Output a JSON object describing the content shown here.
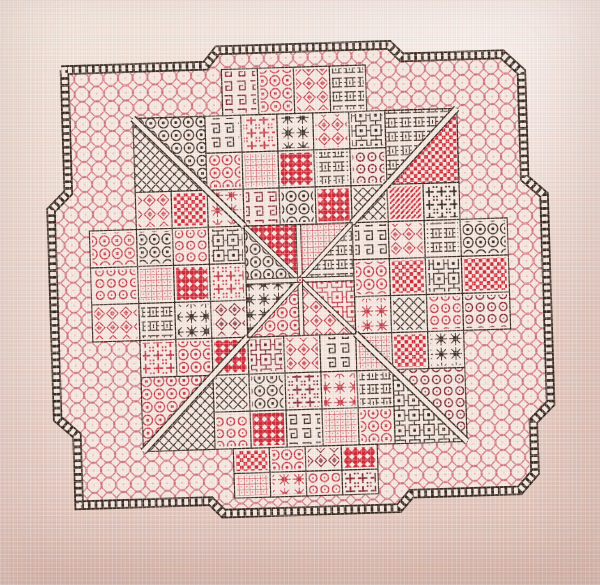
{
  "scene": {
    "type": "photograph",
    "subject": "Blackwork embroidery sampler stitched in black and red thread on pale pink aida fabric; square patchwork of diaper-pattern blocks inside a stepped ladder border with a honeycomb band and a central eight-wedge star",
    "fabric_colors": {
      "highlight": "#f6ece2",
      "base": "#eedcd2",
      "shadow": "#dfc2b7"
    },
    "thread_colors": {
      "black": "#362a20",
      "red": "#c23744",
      "brightred": "#cf2a39",
      "darkred": "#7d2530",
      "pink": "#cb5f6b",
      "white": "#f6e9e2"
    }
  },
  "design": {
    "rotation_deg": -1.8,
    "scale": [
      1.045,
      1.075
    ],
    "canvas": {
      "left": 48,
      "top": 52,
      "width": 520,
      "height": 490
    },
    "outline_points": [
      [
        30,
        26
      ],
      [
        168,
        26
      ],
      [
        180,
        12
      ],
      [
        344,
        12
      ],
      [
        356,
        24
      ],
      [
        452,
        24
      ],
      [
        470,
        41
      ],
      [
        470,
        140
      ],
      [
        488,
        156
      ],
      [
        488,
        350
      ],
      [
        471,
        366
      ],
      [
        471,
        414
      ],
      [
        456,
        430
      ],
      [
        352,
        430
      ],
      [
        340,
        443
      ],
      [
        172,
        443
      ],
      [
        160,
        431
      ],
      [
        34,
        431
      ],
      [
        34,
        366
      ],
      [
        16,
        350
      ],
      [
        16,
        156
      ],
      [
        33,
        140
      ],
      [
        33,
        26
      ]
    ],
    "ladder": {
      "band_width": 9,
      "inner_width": 5.6,
      "dash_on": 3.8,
      "dash_off": 2.6
    },
    "band_pattern": "honey.pink",
    "field": {
      "x": 97,
      "y": 73,
      "cell": 34.44,
      "cols": 9,
      "rows": 9
    },
    "grid": [
      [
        null,
        null,
        "knot.black",
        "cross.red",
        "star.black",
        "flower.red",
        "scroll.black",
        null,
        null
      ],
      [
        null,
        null,
        "oct.red",
        "grid.red",
        "dense.brightred",
        "basket.black",
        "rings.darkred",
        null,
        null
      ],
      [
        "flower.red",
        "checker.brightred",
        "star.red",
        "knot.darkred",
        "oct.black",
        "dense.brightred",
        "lattice.black",
        "hatch.brightred",
        "cross.black"
      ],
      [
        "oct.black",
        "rings.red",
        "scroll.black",
        null,
        null,
        null,
        "knot.black",
        "flower.red",
        "basket.black"
      ],
      [
        "grid.red",
        "dense.brightred",
        "cross.red",
        null,
        null,
        null,
        "oct.red",
        "checker.brightred",
        "scroll.black"
      ],
      [
        "basket.black",
        "star.black",
        "flower.darkred",
        null,
        null,
        null,
        "star.red",
        "lattice.black",
        "rings.red"
      ],
      [
        "cross.red",
        "oct.red",
        "dense.brightred",
        "scroll.darkred",
        "flower.red",
        "knot.black",
        "grid.red",
        "checker.brightred",
        "star.black"
      ],
      [
        null,
        null,
        "lattice.black",
        "oct.black",
        "cross.darkred",
        "star.red",
        "basket.black",
        null,
        null
      ],
      [
        null,
        null,
        "rings.red",
        "dense.brightred",
        "knot.black",
        "grid.red",
        "oct.red",
        null,
        null
      ]
    ],
    "corner_blocks": {
      "tl": [
        "oct.black",
        "lattice.black"
      ],
      "tr": [
        "basket.black",
        "checker.brightred"
      ],
      "bl": [
        "oct.red",
        "lattice.black"
      ],
      "br": [
        "rings.darkred",
        "scroll.black"
      ]
    },
    "center": {
      "wedges": [
        "dense.brightred",
        "grid.red",
        "basket.black",
        "scroll.red",
        "flower.red",
        "oct.red",
        "star.black",
        "oct.black"
      ]
    },
    "extensions": {
      "top": {
        "x": 183.1,
        "y": 30,
        "w": 34.44,
        "h": 43,
        "patterns": [
          "knot.darkred",
          "oct.red",
          "flower.red",
          "basket.black"
        ]
      },
      "bottom": {
        "x": 183.1,
        "y": 383,
        "w": 34.44,
        "h": 23,
        "rows": [
          [
            "checker.brightred",
            "oct.red",
            "flower.darkred",
            "dense.brightred"
          ],
          [
            "grid.red",
            "star.red",
            "rings.red",
            "cross.darkred"
          ]
        ]
      },
      "left": {
        "x": 52,
        "y": 176.32,
        "w": 45,
        "h": 34.44,
        "patterns": [
          "oct.red",
          "rings.red",
          "flower.red"
        ]
      },
      "right": {
        "x": 407,
        "y": 176.32,
        "w": 45,
        "h": 34.44,
        "patterns": [
          "oct.black",
          "checker.brightred",
          "rings.darkred"
        ]
      }
    },
    "pattern_library": {
      "honey": "honeycomb eyelet mesh (border band)",
      "oct": "linked octagons with square eyes",
      "lattice": "diagonal trellis",
      "knot": "greek key maze",
      "basket": "woven ladder weave",
      "cross": "crosses with corner dots",
      "flower": "diamond flower",
      "checker": "solid checkerboard",
      "hatch": "dense diagonal darning",
      "rings": "ringed dots",
      "grid": "fine darned grid",
      "star": "eight point star",
      "scroll": "framed squares",
      "dense": "solid fill with diamond eyelets"
    }
  }
}
